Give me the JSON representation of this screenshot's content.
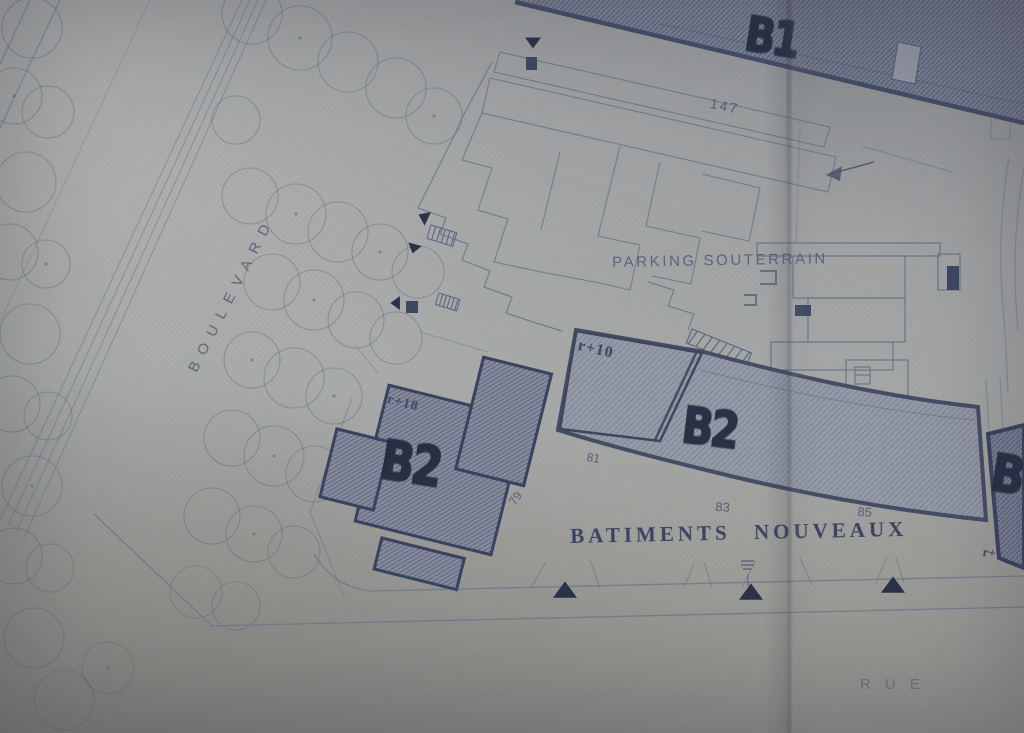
{
  "labels": {
    "b1": "B1",
    "b2_left": "B2",
    "b2_mid": "B2",
    "b3": "B",
    "parking": "PARKING SOUTERRAIN",
    "batiments": "BATIMENTS NOUVEAUX",
    "boulevard": "BOULEVARD",
    "rue": "RUE",
    "n147": "147",
    "n79": "79",
    "n81": "81",
    "n83": "83",
    "n85": "85",
    "r10": "r+10",
    "r18": "r+18",
    "r_partial": "r+"
  },
  "colors": {
    "paper": "#aaaba8",
    "line_ink": "#6b7489",
    "heavy_ink": "#3f4760",
    "marker_ink": "#232a3e",
    "building_fill": "#7d8398"
  },
  "scene": {
    "trees": [
      {
        "x": 32,
        "y": 28,
        "r": 30
      },
      {
        "x": 14,
        "y": 96,
        "r": 28,
        "d": 1
      },
      {
        "x": 48,
        "y": 112,
        "r": 26
      },
      {
        "x": 26,
        "y": 182,
        "r": 30
      },
      {
        "x": 10,
        "y": 252,
        "r": 28
      },
      {
        "x": 46,
        "y": 264,
        "r": 24,
        "d": 1
      },
      {
        "x": 30,
        "y": 334,
        "r": 30
      },
      {
        "x": 12,
        "y": 404,
        "r": 28
      },
      {
        "x": 48,
        "y": 416,
        "r": 24
      },
      {
        "x": 32,
        "y": 486,
        "r": 30,
        "d": 1
      },
      {
        "x": 14,
        "y": 556,
        "r": 28
      },
      {
        "x": 50,
        "y": 568,
        "r": 24
      },
      {
        "x": 34,
        "y": 638,
        "r": 30
      },
      {
        "x": 64,
        "y": 700,
        "r": 30
      },
      {
        "x": 108,
        "y": 668,
        "r": 26,
        "d": 1
      },
      {
        "x": 252,
        "y": 14,
        "r": 30
      },
      {
        "x": 300,
        "y": 38,
        "r": 32,
        "d": 1
      },
      {
        "x": 348,
        "y": 62,
        "r": 30
      },
      {
        "x": 396,
        "y": 88,
        "r": 30
      },
      {
        "x": 434,
        "y": 116,
        "r": 28,
        "d": 1
      },
      {
        "x": 236,
        "y": 120,
        "r": 24
      },
      {
        "x": 250,
        "y": 196,
        "r": 28
      },
      {
        "x": 296,
        "y": 214,
        "r": 30,
        "d": 1
      },
      {
        "x": 338,
        "y": 232,
        "r": 30
      },
      {
        "x": 380,
        "y": 252,
        "r": 28,
        "d": 1
      },
      {
        "x": 418,
        "y": 272,
        "r": 26
      },
      {
        "x": 272,
        "y": 282,
        "r": 28
      },
      {
        "x": 314,
        "y": 300,
        "r": 30,
        "d": 1
      },
      {
        "x": 356,
        "y": 320,
        "r": 28
      },
      {
        "x": 396,
        "y": 338,
        "r": 26
      },
      {
        "x": 252,
        "y": 360,
        "r": 28,
        "d": 1
      },
      {
        "x": 294,
        "y": 378,
        "r": 30
      },
      {
        "x": 334,
        "y": 396,
        "r": 28,
        "d": 1
      },
      {
        "x": 232,
        "y": 438,
        "r": 28
      },
      {
        "x": 274,
        "y": 456,
        "r": 30,
        "d": 1
      },
      {
        "x": 314,
        "y": 474,
        "r": 28
      },
      {
        "x": 212,
        "y": 516,
        "r": 28
      },
      {
        "x": 254,
        "y": 534,
        "r": 28,
        "d": 1
      },
      {
        "x": 294,
        "y": 552,
        "r": 26
      },
      {
        "x": 196,
        "y": 592,
        "r": 26
      },
      {
        "x": 236,
        "y": 606,
        "r": 24
      }
    ],
    "triangles": [
      {
        "x": 533,
        "y": 42,
        "rot": 180,
        "s": 16
      },
      {
        "x": 424,
        "y": 217,
        "rot": -65,
        "s": 15
      },
      {
        "x": 414,
        "y": 248,
        "rot": 195,
        "s": 14
      },
      {
        "x": 396,
        "y": 303,
        "rot": -90,
        "s": 14
      },
      {
        "x": 565,
        "y": 591,
        "rot": 0,
        "s": 24
      },
      {
        "x": 751,
        "y": 593,
        "rot": 0,
        "s": 24
      },
      {
        "x": 893,
        "y": 586,
        "rot": 0,
        "s": 24
      }
    ],
    "squares": [
      {
        "x": 526,
        "y": 57,
        "w": 11,
        "h": 13
      },
      {
        "x": 406,
        "y": 301,
        "w": 12,
        "h": 12
      },
      {
        "x": 795,
        "y": 305,
        "w": 16,
        "h": 11
      },
      {
        "x": 947,
        "y": 266,
        "w": 12,
        "h": 24
      }
    ]
  }
}
